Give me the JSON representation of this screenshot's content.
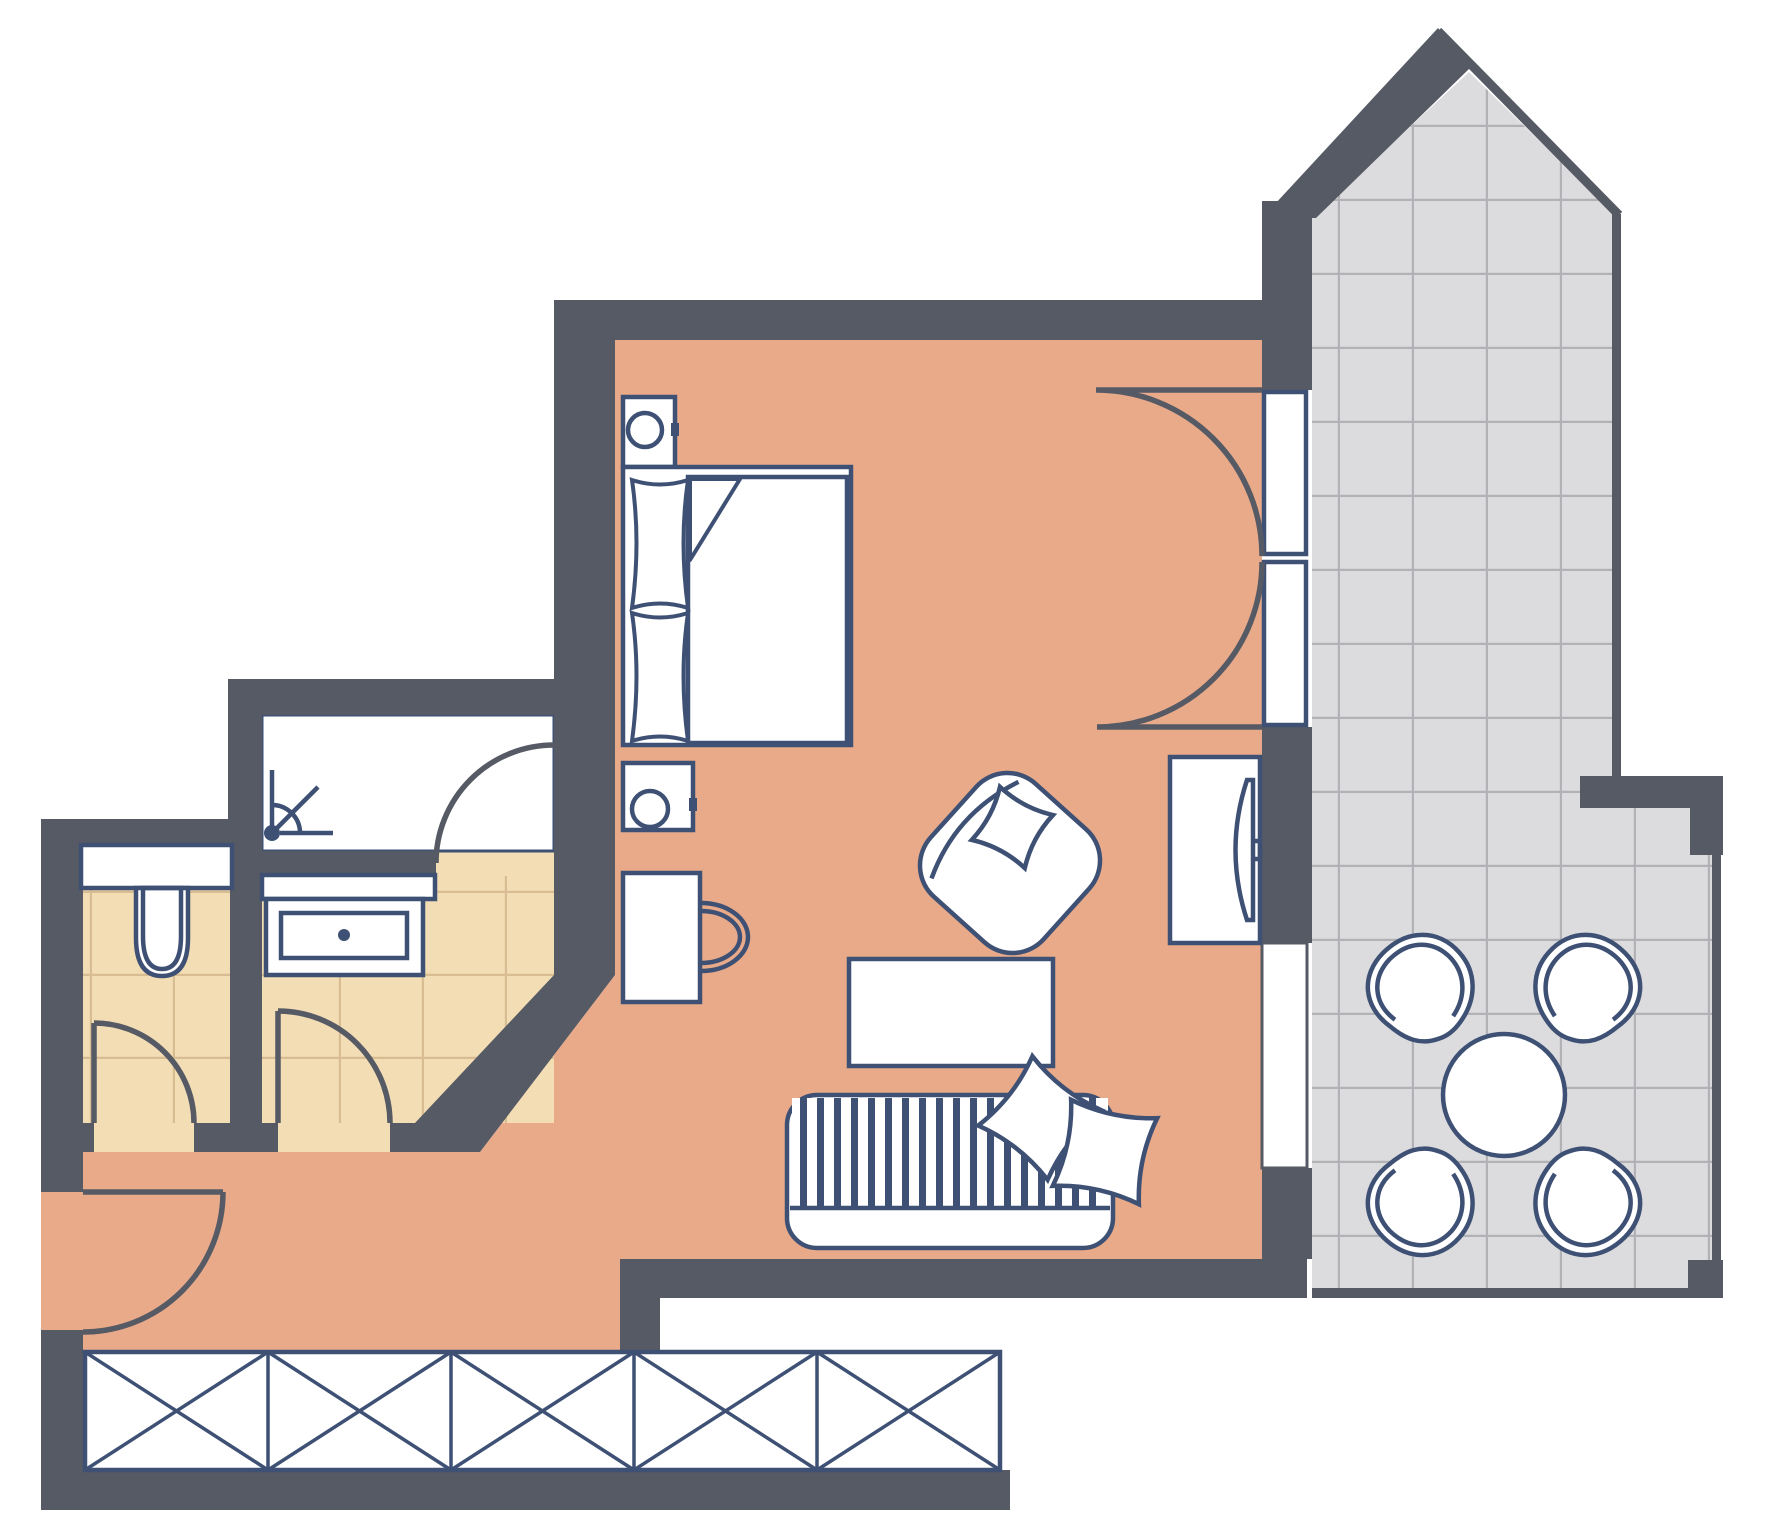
{
  "page": {
    "title": "Apartment floor plan – studio with balcony",
    "type": "architectural floor plan",
    "visible_text": []
  },
  "palette": {
    "background": "#ffffff",
    "wall": "#565a64",
    "living_floor": "#e9aa8a",
    "bath_floor": "#f3ddb5",
    "bath_grid": "#d9bd92",
    "balcony_floor": "#dcdcde",
    "balcony_grid": "#b2b2b6",
    "outline": "#3e5175",
    "fixture_fill": "#ffffff"
  },
  "rooms": [
    {
      "name": "living-bedroom",
      "floor_color_key": "living_floor"
    },
    {
      "name": "hallway-entry",
      "floor_color_key": "living_floor"
    },
    {
      "name": "wc-room",
      "floor_color_key": "bath_floor"
    },
    {
      "name": "bathroom-vanity-room",
      "floor_color_key": "bath_floor"
    },
    {
      "name": "shower-room",
      "floor_color_key": "fixture_fill"
    },
    {
      "name": "balcony-terrace",
      "floor_color_key": "balcony_floor"
    }
  ],
  "furniture": [
    "double-bed-with-pillows-and-duvet",
    "nightstand-head",
    "nightstand-foot",
    "desk-with-chair",
    "armchair-with-cushion",
    "coffee-table",
    "striped-sofa-with-two-cushions",
    "tv-sideboard",
    "round-balcony-table",
    "balcony-chair-x4",
    "toilet-with-cistern",
    "vanity-washbasin",
    "shower-spray-symbol",
    "built-in-wardrobe-5-sections"
  ],
  "doors": [
    "entry-door",
    "wc-door",
    "bathroom-door",
    "shower-room-door",
    "balcony-double-door",
    "balcony-window"
  ]
}
